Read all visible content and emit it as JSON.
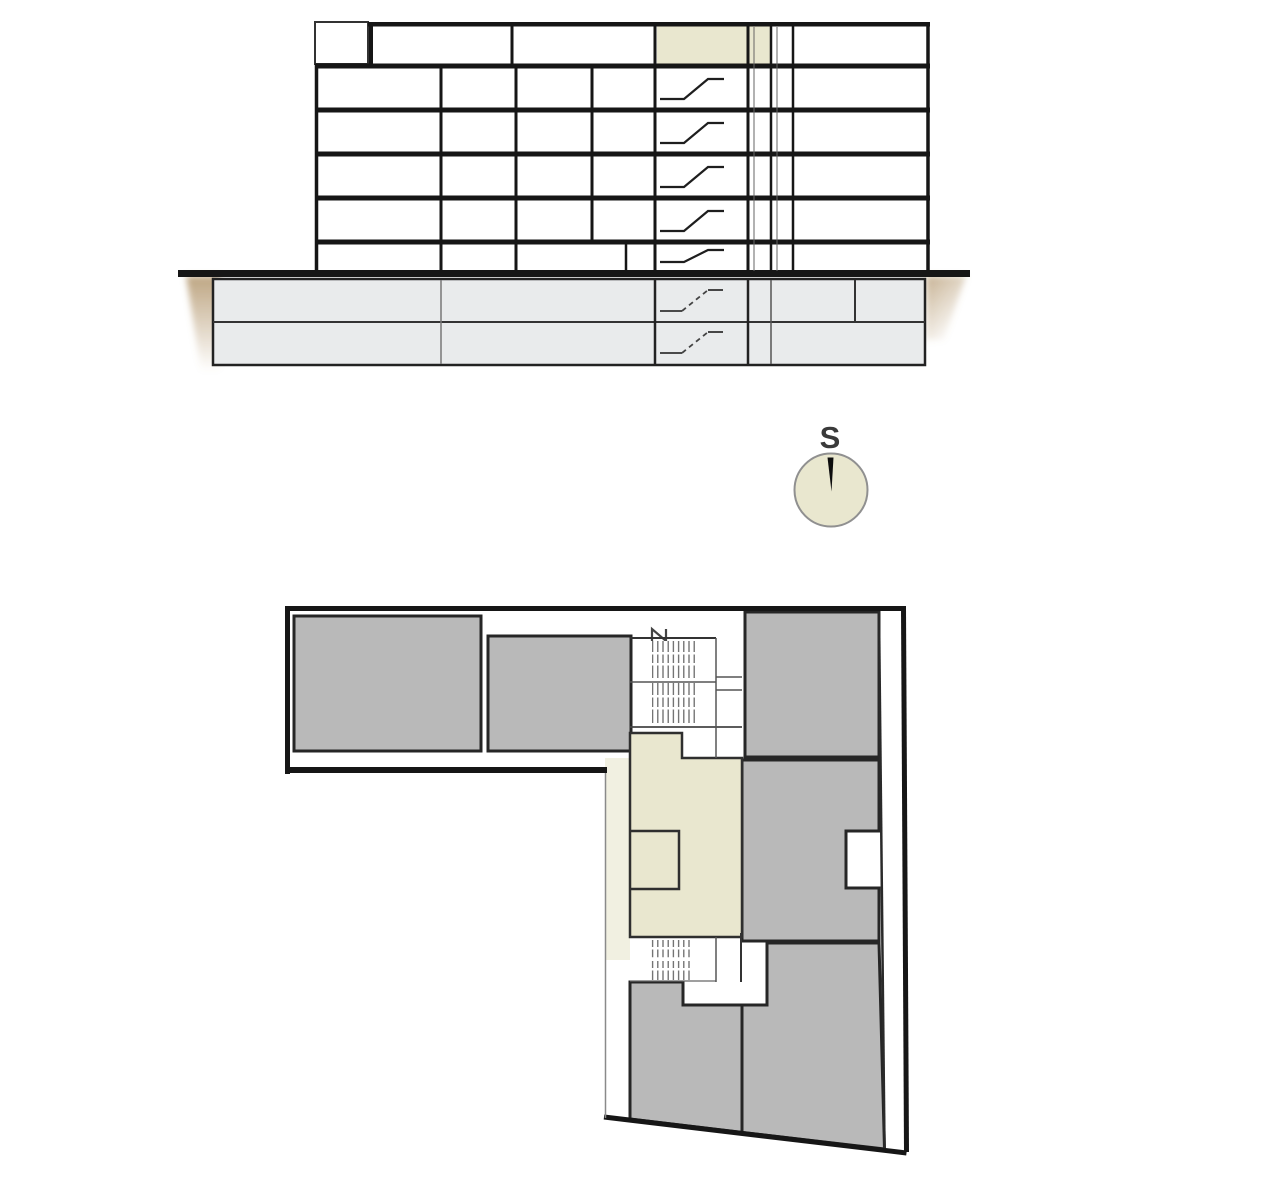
{
  "compass": {
    "label": "S"
  },
  "colors": {
    "background": "#ffffff",
    "wall": "#161616",
    "wall_medium": "#2b2b2b",
    "thin_line": "#6e6e6e",
    "highlight": "#e9e7cf",
    "highlight_light": "#f1f0e1",
    "room_fill": "#b9b9b9",
    "basement_fill": "#e9ebec",
    "earth": "#a9895a",
    "compass_stroke": "#909090",
    "needle": "#0d0d0d",
    "label_color": "#3a3a3a"
  },
  "section": {
    "floors_above_ground": 6,
    "basement_levels": 2,
    "highlighted_unit_floor": "top"
  },
  "plan": {
    "gray_room_count": 6,
    "highlighted_unit_count": 1
  }
}
